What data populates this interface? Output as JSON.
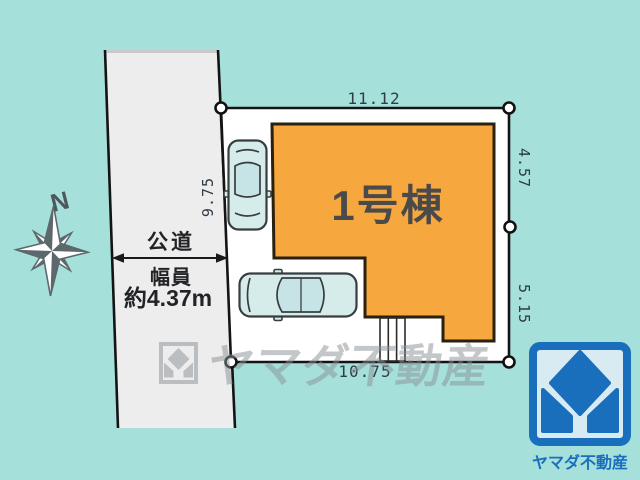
{
  "site_plan": {
    "building": {
      "label": "1号棟"
    },
    "dimensions": {
      "top": "11.12",
      "left": "9.75",
      "right_upper": "4.57",
      "right_lower": "5.15",
      "bottom": "10.75"
    },
    "road": {
      "label": "公道",
      "width_caption": "幅員",
      "width_value": "約4.37m"
    },
    "compass": {
      "label": "N"
    }
  },
  "watermark": {
    "text": "ヤマダ不動産"
  },
  "brand": {
    "logo_text": "ヤマダ不動産"
  },
  "colors": {
    "background": "#a6e0db",
    "road": "#ededed",
    "lot": "#ffffff",
    "building": "#f6a73e",
    "building_border": "#29200f",
    "brand_blue": "#1a6fbd",
    "car_body": "#d5eceb",
    "dimension_text": "#2f3b46",
    "watermark_gray": "#8b9196"
  }
}
